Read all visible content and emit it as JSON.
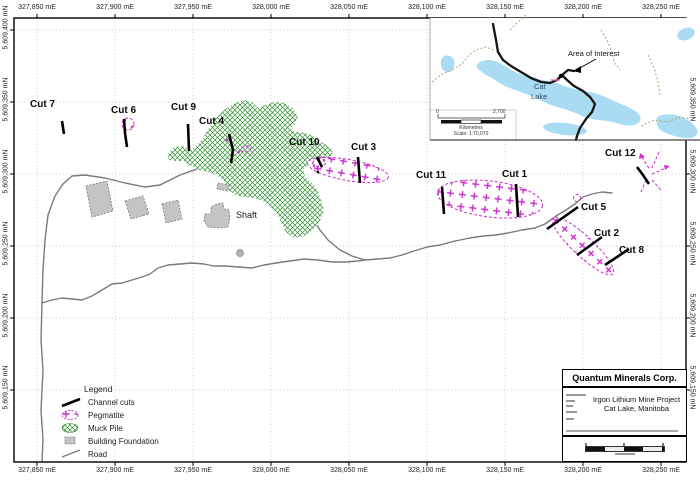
{
  "axes": {
    "top": [
      "327,850 mE",
      "327,900 mE",
      "327,950 mE",
      "328,000 mE",
      "328,050 mE",
      "328,100 mE",
      "328,150 mE",
      "328,200 mE",
      "328,250 mE"
    ],
    "bottom": [
      "327,850 mE",
      "327,900 mE",
      "327,950 mE",
      "328,000 mE",
      "328,050 mE",
      "328,100 mE",
      "328,150 mE",
      "328,200 mE",
      "328,250 mE"
    ],
    "left": [
      "5,609,400 mN",
      "5,609,350 mN",
      "5,609,300 mN",
      "5,609,250 mN",
      "5,609,200 mN",
      "5,609,150 mN"
    ],
    "right": [
      "5,609,350 mN",
      "5,609,300 mN",
      "5,609,250 mN",
      "5,609,200 mN",
      "5,609,150 mN"
    ]
  },
  "cuts": [
    {
      "label": "Cut 7"
    },
    {
      "label": "Cut 6"
    },
    {
      "label": "Cut 9"
    },
    {
      "label": "Cut 4"
    },
    {
      "label": "Cut 10"
    },
    {
      "label": "Cut 3"
    },
    {
      "label": "Cut 11"
    },
    {
      "label": "Cut 1"
    },
    {
      "label": "Cut 12"
    },
    {
      "label": "Cut 5"
    },
    {
      "label": "Cut 2"
    },
    {
      "label": "Cut 8"
    }
  ],
  "map": {
    "shaft_label": "Shaft"
  },
  "legend": {
    "title": "Legend",
    "items": [
      {
        "label": "Channel cuts"
      },
      {
        "label": "Pegmatite"
      },
      {
        "label": "Muck Pile"
      },
      {
        "label": "Building Foundation"
      },
      {
        "label": "Road"
      }
    ]
  },
  "inset": {
    "area_of_interest": "Area of Interest",
    "lake_name_line1": "Cat",
    "lake_name_line2": "Lake",
    "scale_zero": "0",
    "scale_max": "2,700",
    "scale_units": "Kilometres",
    "scale_ratio": "Scale: 1:70,070"
  },
  "title_block": {
    "company": "Quantum Minerals Corp.",
    "project_line1": "Irgon Lithium Mine Project",
    "project_line2": "Cat Lake, Manitoba"
  },
  "colors": {
    "pegmatite": "#cc2fcc",
    "muck_pile": "#2f8f2f",
    "road": "#7a7a7a",
    "lake": "#a9dcf2",
    "channel_cut": "#000000"
  }
}
